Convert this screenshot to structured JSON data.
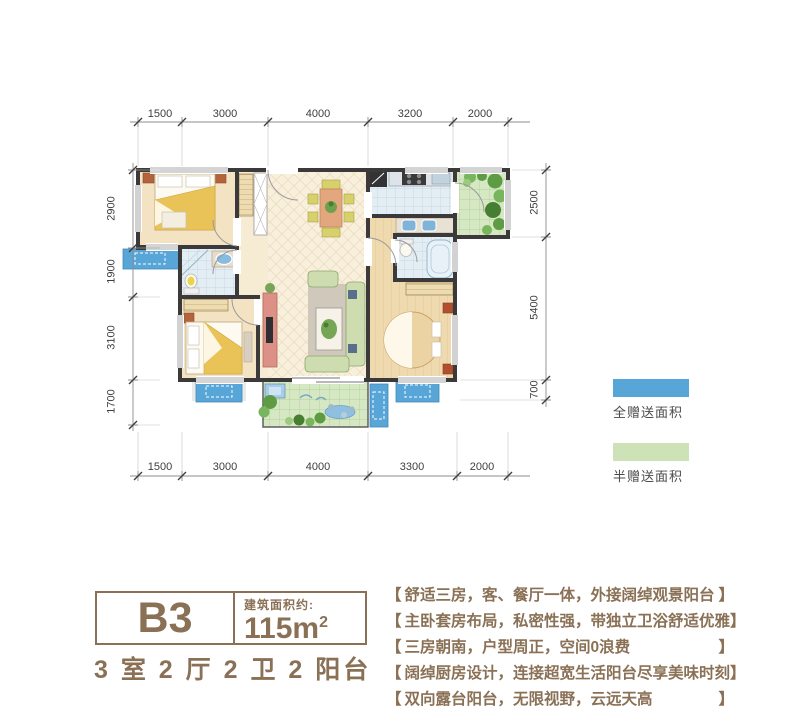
{
  "floor_plan": {
    "unit_name": "B3",
    "area_caption": "建筑面积约:",
    "area_value": "115m",
    "area_sup": "2",
    "rooms_summary": "3 室 2 厅 2 卫 2 阳台"
  },
  "dimensions": {
    "top": [
      "1500",
      "3000",
      "4000",
      "3200",
      "2000"
    ],
    "bottom": [
      "1500",
      "3000",
      "4000",
      "3300",
      "2000"
    ],
    "left": [
      "2900",
      "1900",
      "3100",
      "1700"
    ],
    "right": [
      "2500",
      "5400",
      "700"
    ]
  },
  "legend": {
    "items": [
      {
        "label": "全赠送面积",
        "color": "#58a6d7"
      },
      {
        "label": "半赠送面积",
        "color": "#cde2b6"
      }
    ]
  },
  "features": {
    "bracket_open": "【",
    "bracket_close": "】",
    "items": [
      "舒适三房，客、餐厅一体，外接阔绰观景阳台",
      "主卧套房布局，私密性强，带独立卫浴舒适优雅",
      "三房朝南，户型周正，空间0浪费",
      "阔绰厨房设计，连接超宽生活阳台尽享美味时刻",
      "双向露台阳台，无限视野，云远天高"
    ]
  },
  "colors": {
    "accent_brown": "#8a7156",
    "full_gift_blue": "#58a6d7",
    "half_gift_green": "#cde2b6",
    "wall_dark": "#3b393a",
    "dim_text": "#3e3e3e"
  }
}
